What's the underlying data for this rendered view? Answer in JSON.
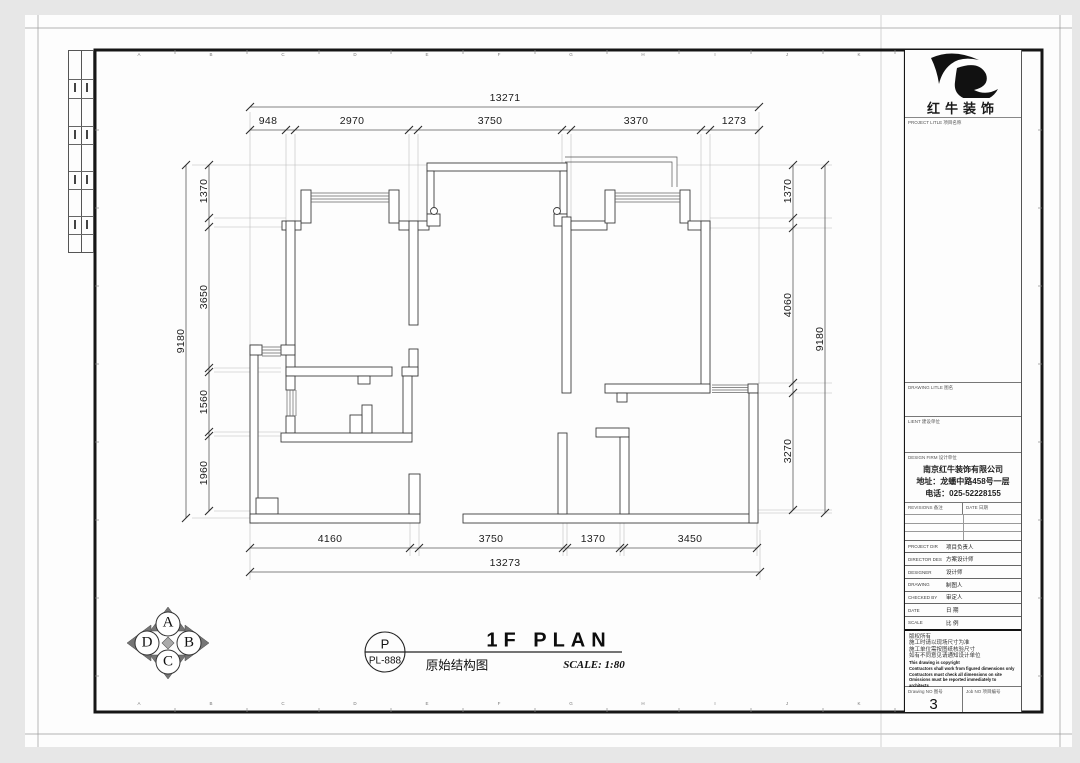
{
  "plan_title": {
    "tag_letter": "P",
    "tag_code": "PL-888",
    "title": "1F PLAN",
    "subtitle_zh": "原始结构图",
    "scale_text": "SCALE: 1:80"
  },
  "compass": {
    "top": "A",
    "right": "B",
    "bottom": "C",
    "left": "D"
  },
  "title_block": {
    "brand_name": "红牛装饰",
    "project_title_label": "PROJECT LITLE 项目名称",
    "drawing_title_label": "DRAWING LITLE 图名",
    "client_label": "LIENT 建设单位",
    "design_firm_label": "DESIGN FIRM 设计单位",
    "company_name": "南京红牛装饰有限公司",
    "company_address": "地址：龙蟠中路458号一层",
    "company_phone": "电话：025-52228155",
    "revisions_label": "REVISIONS 备注",
    "revision_date_label": "DATE 日期",
    "personnel_rows": [
      {
        "en": "PROJECT DIR",
        "zh": "项目负责人"
      },
      {
        "en": "DIRECTOR DES",
        "zh": "方案设计师"
      },
      {
        "en": "DESIGNER",
        "zh": "设计师"
      },
      {
        "en": "DRAWING",
        "zh": "制图人"
      },
      {
        "en": "CHECKED BY",
        "zh": "审定人"
      },
      {
        "en": "DATE",
        "zh": "日 期"
      },
      {
        "en": "SCALE",
        "zh": "比 例"
      }
    ],
    "notes": [
      "版权所有",
      "施工时请以现场尺寸为准",
      "施工单位需按图纸核验尺寸",
      "如有不同意见请通知设计单位",
      "This drawing is copyright",
      "Contractors shall work from figured dimensions only",
      "Contractors must check all dimensions on site",
      "Omissions must be reported immediately to architects"
    ],
    "drawing_no_label": "Drawing NO 图号",
    "drawing_no_value": "3",
    "job_no_label": "Job NO 项目编号"
  },
  "frame_grid_letters": [
    "A",
    "B",
    "C",
    "D",
    "E",
    "F",
    "G",
    "H",
    "I",
    "J",
    "K"
  ],
  "dimensions": {
    "labels": [
      {
        "t": "13271",
        "x": 505,
        "y": 104,
        "v": 0
      },
      {
        "t": "948",
        "x": 268,
        "y": 127,
        "v": 0
      },
      {
        "t": "2970",
        "x": 352,
        "y": 127,
        "v": 0
      },
      {
        "t": "3750",
        "x": 490,
        "y": 127,
        "v": 0
      },
      {
        "t": "3370",
        "x": 636,
        "y": 127,
        "v": 0
      },
      {
        "t": "1273",
        "x": 734,
        "y": 127,
        "v": 0
      },
      {
        "t": "9180",
        "x": 181,
        "y": 341,
        "v": 1
      },
      {
        "t": "1370",
        "x": 204,
        "y": 191,
        "v": 1
      },
      {
        "t": "3650",
        "x": 204,
        "y": 297,
        "v": 1
      },
      {
        "t": "1560",
        "x": 204,
        "y": 402,
        "v": 1
      },
      {
        "t": "1960",
        "x": 204,
        "y": 473,
        "v": 1
      },
      {
        "t": "1370",
        "x": 788,
        "y": 191,
        "v": 1
      },
      {
        "t": "4060",
        "x": 788,
        "y": 305,
        "v": 1
      },
      {
        "t": "3270",
        "x": 788,
        "y": 451,
        "v": 1
      },
      {
        "t": "9180",
        "x": 820,
        "y": 339,
        "v": 1
      },
      {
        "t": "4160",
        "x": 330,
        "y": 545,
        "v": 0
      },
      {
        "t": "3750",
        "x": 491,
        "y": 545,
        "v": 0
      },
      {
        "t": "1370",
        "x": 593,
        "y": 545,
        "v": 0
      },
      {
        "t": "3450",
        "x": 690,
        "y": 545,
        "v": 0
      },
      {
        "t": "13273",
        "x": 505,
        "y": 569,
        "v": 0
      }
    ],
    "dim_lines": [
      {
        "o": "h",
        "p": 107,
        "a": 250,
        "b": 759,
        "t": [
          250,
          759
        ]
      },
      {
        "o": "h",
        "p": 130,
        "a": 250,
        "b": 759,
        "t": [
          250,
          286,
          295,
          409,
          418,
          562,
          571,
          701,
          710,
          759
        ]
      },
      {
        "o": "h",
        "p": 548,
        "a": 250,
        "b": 757,
        "t": [
          250,
          410,
          419,
          563,
          567,
          620,
          624,
          757
        ]
      },
      {
        "o": "h",
        "p": 572,
        "a": 250,
        "b": 760,
        "t": [
          250,
          760
        ]
      },
      {
        "o": "v",
        "p": 186,
        "a": 165,
        "b": 518,
        "t": [
          165,
          518
        ]
      },
      {
        "o": "v",
        "p": 209,
        "a": 165,
        "b": 511,
        "t": [
          165,
          218,
          227,
          368,
          372,
          432,
          436,
          511
        ]
      },
      {
        "o": "v",
        "p": 793,
        "a": 165,
        "b": 510,
        "t": [
          165,
          218,
          228,
          383,
          393,
          510
        ]
      },
      {
        "o": "v",
        "p": 825,
        "a": 165,
        "b": 513,
        "t": [
          165,
          513
        ]
      }
    ],
    "ext_segments": [
      [
        250,
        112,
        250,
        345
      ],
      [
        286,
        134,
        286,
        221
      ],
      [
        295,
        134,
        295,
        221
      ],
      [
        409,
        134,
        409,
        221
      ],
      [
        418,
        134,
        418,
        221
      ],
      [
        562,
        134,
        562,
        163
      ],
      [
        571,
        134,
        571,
        217
      ],
      [
        701,
        134,
        701,
        221
      ],
      [
        710,
        134,
        710,
        221
      ],
      [
        759,
        112,
        759,
        384
      ],
      [
        192,
        165,
        427,
        165
      ],
      [
        214,
        218,
        286,
        218
      ],
      [
        214,
        227,
        286,
        227
      ],
      [
        214,
        368,
        281,
        368
      ],
      [
        214,
        372,
        281,
        372
      ],
      [
        214,
        432,
        281,
        432
      ],
      [
        214,
        436,
        281,
        436
      ],
      [
        214,
        511,
        250,
        511
      ],
      [
        192,
        518,
        250,
        518
      ],
      [
        677,
        165,
        832,
        165
      ],
      [
        710,
        218,
        832,
        218
      ],
      [
        710,
        228,
        832,
        228
      ],
      [
        758,
        383,
        832,
        383
      ],
      [
        758,
        393,
        832,
        393
      ],
      [
        758,
        510,
        832,
        510
      ],
      [
        758,
        513,
        832,
        513
      ],
      [
        250,
        523,
        250,
        580
      ],
      [
        410,
        523,
        410,
        556
      ],
      [
        419,
        523,
        419,
        556
      ],
      [
        563,
        523,
        563,
        556
      ],
      [
        567,
        523,
        567,
        556
      ],
      [
        620,
        523,
        620,
        556
      ],
      [
        624,
        523,
        624,
        556
      ],
      [
        757,
        523,
        757,
        556
      ],
      [
        760,
        530,
        760,
        580
      ]
    ]
  }
}
